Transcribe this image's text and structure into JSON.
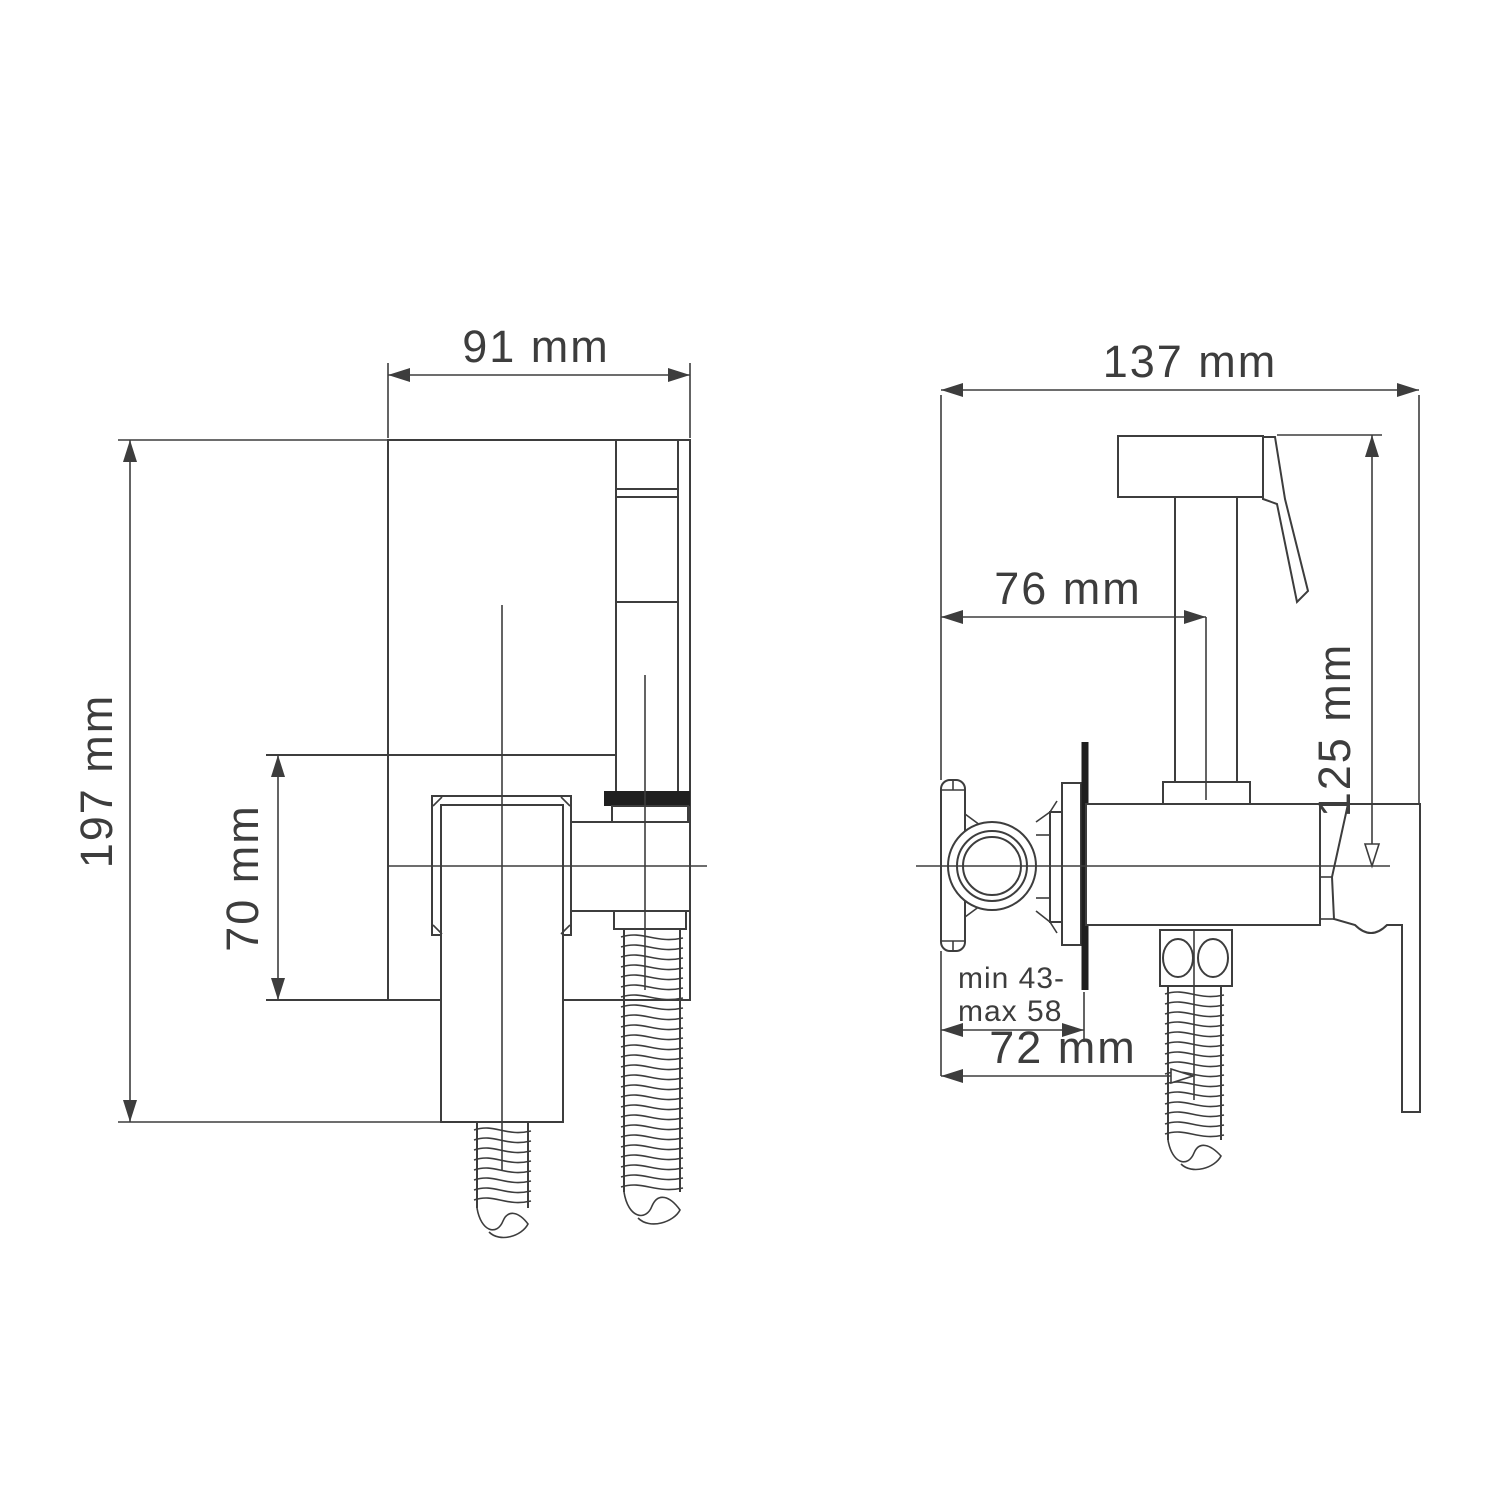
{
  "drawing": {
    "front_view": {
      "width_label": "91 mm",
      "height_label": "197 mm",
      "outlet_height_label": "70 mm"
    },
    "side_view": {
      "depth_label": "137 mm",
      "spray_offset_label": "76 mm",
      "height_label": "125 mm",
      "wall_range_line1": "min 43-",
      "wall_range_line2": "max 58",
      "hose_offset_label": "72 mm"
    }
  }
}
